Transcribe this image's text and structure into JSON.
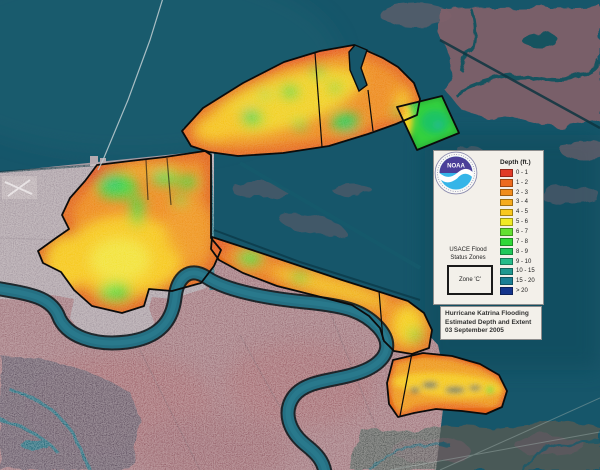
{
  "panel": {
    "noaa_label": "NOAA",
    "depth_title": "Depth (ft.)",
    "depth_items": [
      {
        "label": "0 - 1",
        "color": "#e13b28"
      },
      {
        "label": "1 - 2",
        "color": "#ec6a1e"
      },
      {
        "label": "2 - 3",
        "color": "#f08c1c"
      },
      {
        "label": "3 - 4",
        "color": "#f5ab1e"
      },
      {
        "label": "4 - 5",
        "color": "#f9c81e"
      },
      {
        "label": "5 - 6",
        "color": "#f0ea26"
      },
      {
        "label": "6 - 7",
        "color": "#63e032"
      },
      {
        "label": "7 - 8",
        "color": "#2fd838"
      },
      {
        "label": "8 - 9",
        "color": "#1fc85a"
      },
      {
        "label": "9 - 10",
        "color": "#26bc8a"
      },
      {
        "label": "10 - 15",
        "color": "#1f9890"
      },
      {
        "label": "15 - 20",
        "color": "#1a7e94"
      },
      {
        "label": "> 20",
        "color": "#14348c"
      }
    ],
    "usace_line1": "USACE Flood",
    "usace_line2": "Status Zones",
    "zone_label": "Zone 'C'"
  },
  "title_box": {
    "line1": "Hurricane Katrina Flooding",
    "line2": "Estimated Depth and Extent",
    "line3": "03 September 2005"
  },
  "map": {
    "colors": {
      "water": "#16566a",
      "lake": "#1a5f70",
      "urban": "#a69aa2",
      "westbank": "#9c7078",
      "marsh": "#7e6069",
      "river": "#257083",
      "outline": "#0b0b0b",
      "flood-base": "#ee8b1d"
    }
  }
}
